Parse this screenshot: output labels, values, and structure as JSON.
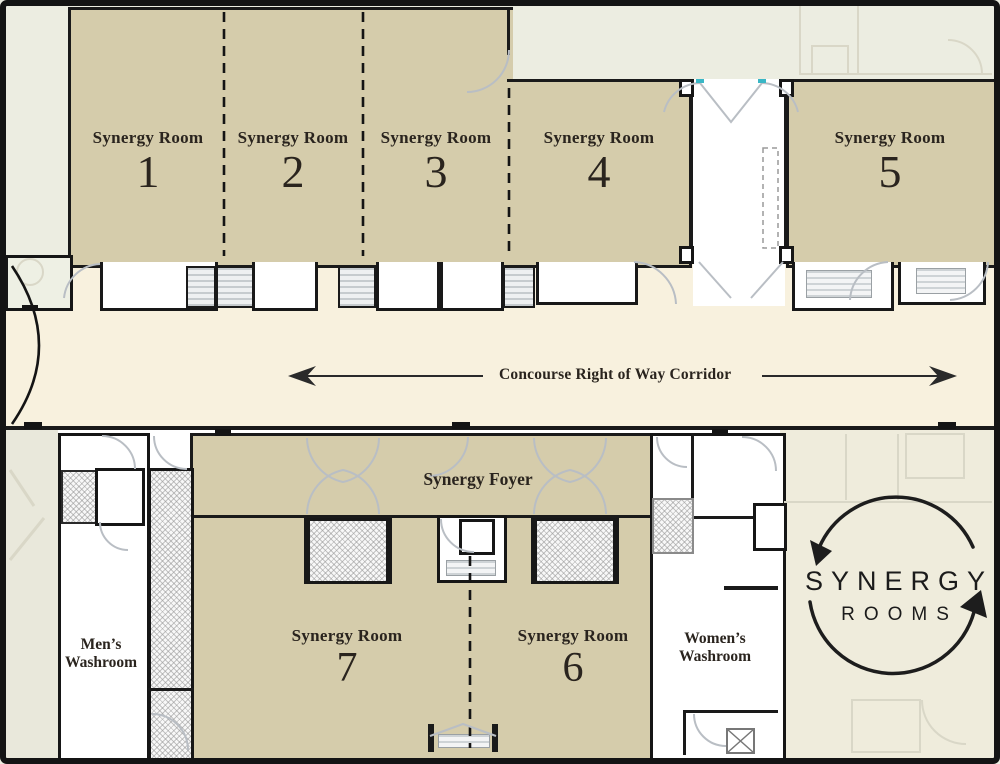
{
  "floor_plan": {
    "rooms": [
      {
        "name": "Synergy Room",
        "number": "1"
      },
      {
        "name": "Synergy Room",
        "number": "2"
      },
      {
        "name": "Synergy Room",
        "number": "3"
      },
      {
        "name": "Synergy Room",
        "number": "4"
      },
      {
        "name": "Synergy Room",
        "number": "5"
      },
      {
        "name": "Synergy Room",
        "number": "7"
      },
      {
        "name": "Synergy Room",
        "number": "6"
      }
    ],
    "foyer": {
      "label": "Synergy Foyer"
    },
    "corridor": {
      "label": "Concourse Right of Way Corridor"
    },
    "washrooms": {
      "mens": {
        "line1": "Men’s",
        "line2": "Washroom"
      },
      "womens": {
        "line1": "Women’s",
        "line2": "Washroom"
      }
    },
    "logo": {
      "primary": "SYNERGY",
      "secondary": "ROOMS"
    },
    "colors": {
      "room_fill": "#d5ccab",
      "corridor_fill": "#f8f1de",
      "wall": "#1a1a1a",
      "background": "#ecede1",
      "background_warm": "#efecdc",
      "door_swing": "#b9bec4",
      "accent_teal": "#3ab7c6",
      "text": "#2a241e"
    }
  }
}
